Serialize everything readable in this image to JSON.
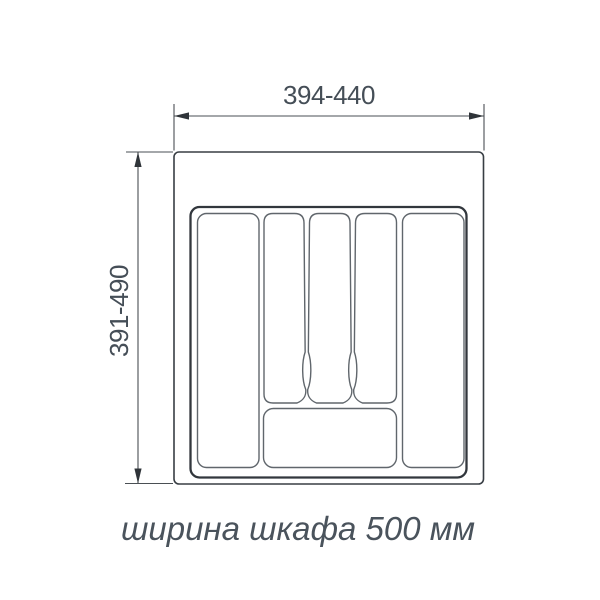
{
  "dimensions": {
    "width": {
      "label": "394-440"
    },
    "height": {
      "label": "391-490"
    }
  },
  "caption": {
    "text": "ширина шкафа 500 мм"
  },
  "colors": {
    "outline": "#383e44",
    "insert_outline": "#32373d",
    "compartment_line": "#60666c",
    "dimension_line": "#4a4f54",
    "arrow": "#2f3439",
    "text": "#454e57",
    "background": "#ffffff"
  }
}
